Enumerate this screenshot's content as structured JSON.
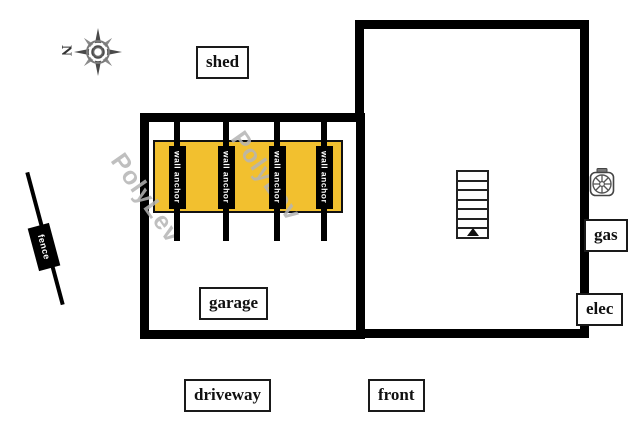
{
  "compass": {
    "north_label": "N"
  },
  "areas": {
    "shed": "shed",
    "garage": "garage",
    "driveway": "driveway",
    "front": "front"
  },
  "utilities": {
    "gas": "gas",
    "elec": "elec"
  },
  "fence": {
    "label": "fence"
  },
  "wall_anchors": {
    "count": 4,
    "items": [
      {
        "label": "wall anchor"
      },
      {
        "label": "wall anchor"
      },
      {
        "label": "wall anchor"
      },
      {
        "label": "wall anchor"
      }
    ]
  },
  "watermarks": [
    {
      "text": "PolyLev"
    },
    {
      "text": "PolyLev"
    }
  ],
  "colors": {
    "wall": "#000000",
    "anchor_zone": "#F2C02F",
    "watermark": "#B5B5B5",
    "label_bg": "#FFFFFF",
    "label_border": "#1A1A1A"
  }
}
